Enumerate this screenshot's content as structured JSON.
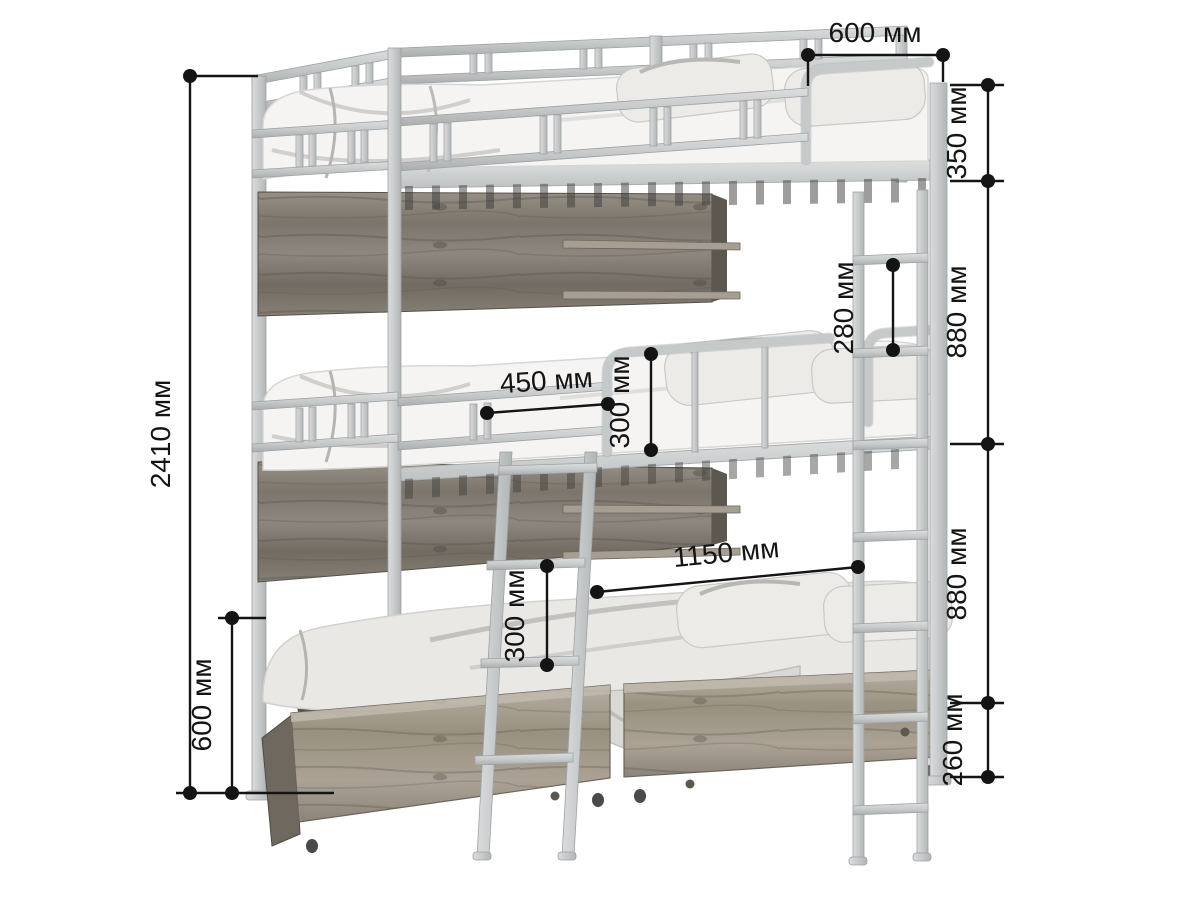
{
  "figure": {
    "kind": "triple bunk bed dimension diagram",
    "unit": "мм",
    "colors": {
      "background": "#ffffff",
      "dimension_lines": "#141414",
      "metal_frame": "#c6c9ca",
      "wood_panels": "#8a847b",
      "drawer_wood": "#a49c90",
      "mattress": "#f5f4f2"
    }
  },
  "dimensions": {
    "bed_width_top": "600 мм",
    "top_rail_height": "350 мм",
    "upper_tier_spacing": "880 мм",
    "lower_tier_spacing": "880 мм",
    "drawer_section_height": "260 мм",
    "right_ladder_step": "280 мм",
    "guard_rail_length": "450 мм",
    "guard_rail_height": "300 мм",
    "clear_length": "1150 мм",
    "front_ladder_step": "300 мм",
    "total_height": "2410 мм",
    "under_bed_clearance": "600 мм"
  }
}
